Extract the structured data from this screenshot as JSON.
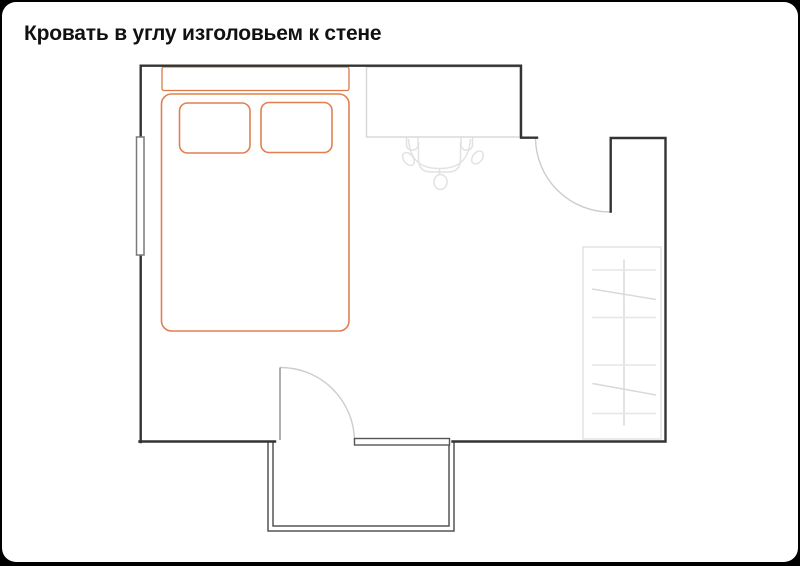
{
  "title": "Кровать в углу изголовьем к стене",
  "diagram": {
    "type": "floor-plan",
    "room": "bedroom",
    "elements": [
      {
        "name": "bed-double",
        "parts": [
          "headboard",
          "mattress",
          "pillow-left",
          "pillow-right"
        ],
        "accent": "orange"
      },
      {
        "name": "desk"
      },
      {
        "name": "desk-chair",
        "parts": [
          "backrest",
          "seat",
          "armrest-left",
          "armrest-right",
          "caster-left",
          "caster-right",
          "caster-front"
        ]
      },
      {
        "name": "window",
        "wall": "left"
      },
      {
        "name": "entry-door",
        "wall": "top-right",
        "swing": "into-room"
      },
      {
        "name": "balcony-door",
        "wall": "bottom",
        "swing": "into-room"
      },
      {
        "name": "balcony",
        "position": "bottom"
      },
      {
        "name": "wardrobe",
        "position": "right",
        "shelves": 4
      }
    ]
  },
  "colors": {
    "background": "#000000",
    "card": "#ffffff",
    "title_text": "#111111",
    "wall": "#333333",
    "bed_accent": "#e0804f",
    "headboard_accent": "#dd7a44",
    "furniture_light": "#d7d7d7",
    "chair_light": "#e2e2e2",
    "door_arc": "#cccccc",
    "door_leaf_gray": "#999999",
    "window_frame": "#7a7a7a",
    "balcony_frame": "#555555"
  }
}
